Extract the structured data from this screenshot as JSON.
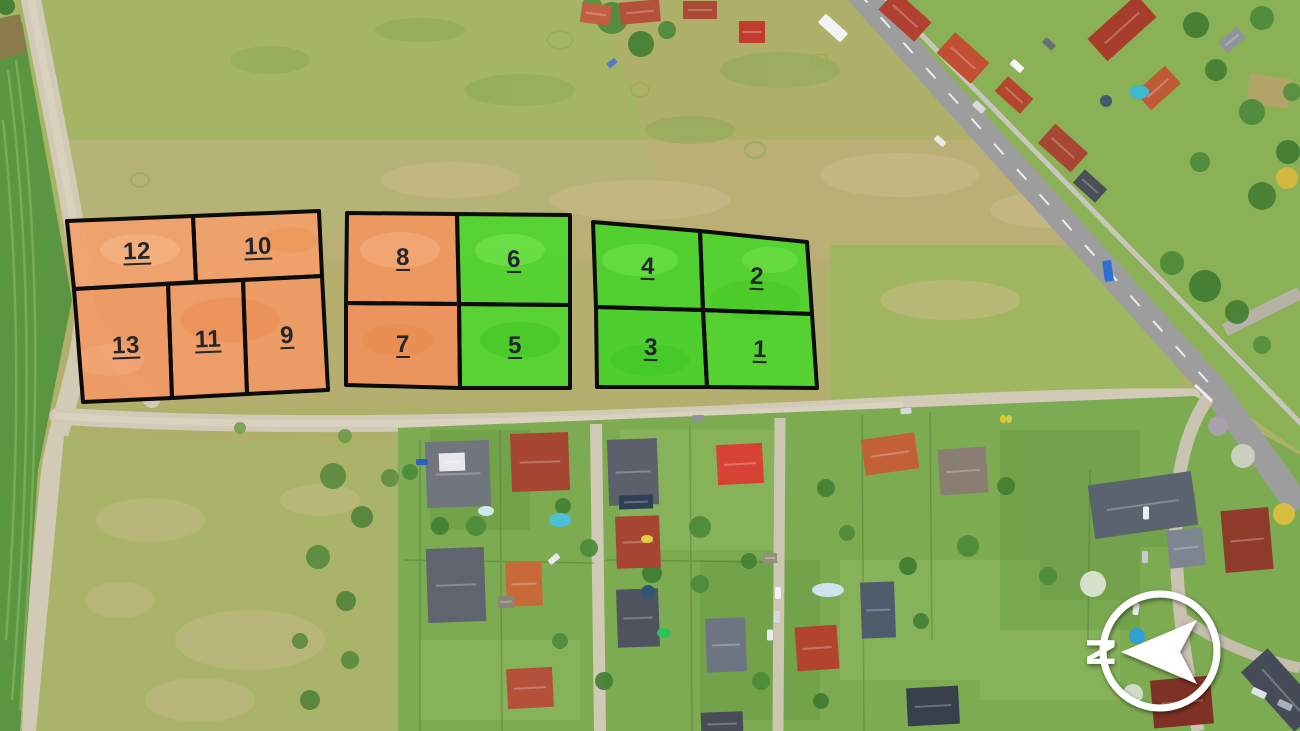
{
  "map": {
    "kind": "aerial-land-plot-overview",
    "plot_count": 13
  },
  "plots": [
    {
      "number": "1",
      "color_name": "green",
      "fill": "#4ed42c"
    },
    {
      "number": "2",
      "color_name": "green",
      "fill": "#4cd32b"
    },
    {
      "number": "3",
      "color_name": "green",
      "fill": "#47d12a"
    },
    {
      "number": "4",
      "color_name": "green",
      "fill": "#49d22b"
    },
    {
      "number": "5",
      "color_name": "green",
      "fill": "#51d52e"
    },
    {
      "number": "6",
      "color_name": "green",
      "fill": "#4fd42d"
    },
    {
      "number": "7",
      "color_name": "orange",
      "fill": "#f0925c"
    },
    {
      "number": "8",
      "color_name": "orange",
      "fill": "#f0975f"
    },
    {
      "number": "9",
      "color_name": "orange",
      "fill": "#f09a64"
    },
    {
      "number": "10",
      "color_name": "orange",
      "fill": "#f2a06b"
    },
    {
      "number": "11",
      "color_name": "orange",
      "fill": "#f19c66"
    },
    {
      "number": "12",
      "color_name": "orange",
      "fill": "#f2a16d"
    },
    {
      "number": "13",
      "color_name": "orange",
      "fill": "#f09a63"
    }
  ],
  "legend_colors": {
    "green_plot": "#4ed42c",
    "orange_plot": "#f0975f",
    "plot_border": "#0c0c0c",
    "label_text": "#24262b"
  },
  "compass": {
    "north_label": "N"
  }
}
